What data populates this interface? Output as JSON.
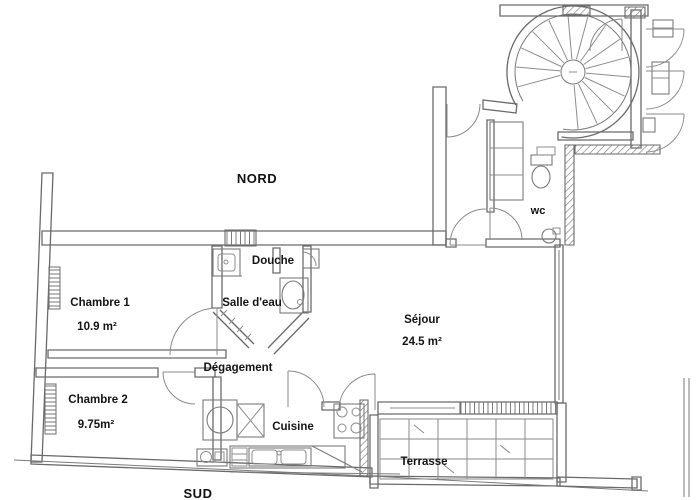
{
  "title": "Plan d'appartement",
  "compass": {
    "north": "NORD",
    "south": "SUD"
  },
  "rooms": {
    "chambre1": {
      "name": "Chambre 1",
      "area": "10.9 m²"
    },
    "chambre2": {
      "name": "Chambre 2",
      "area": "9.75m²"
    },
    "sejour": {
      "name": "Séjour",
      "area": "24.5 m²"
    },
    "cuisine": {
      "name": "Cuisine"
    },
    "douche": {
      "name": "Douche"
    },
    "salle_deau": {
      "name": "Salle d'eau"
    },
    "degagement": {
      "name": "Dégagement"
    },
    "wc": {
      "name": "wc"
    },
    "terrasse": {
      "name": "Terrasse"
    }
  },
  "palette": {
    "ink": "#6a6a6a",
    "label_ink": "#141414",
    "background": "#ffffff"
  }
}
